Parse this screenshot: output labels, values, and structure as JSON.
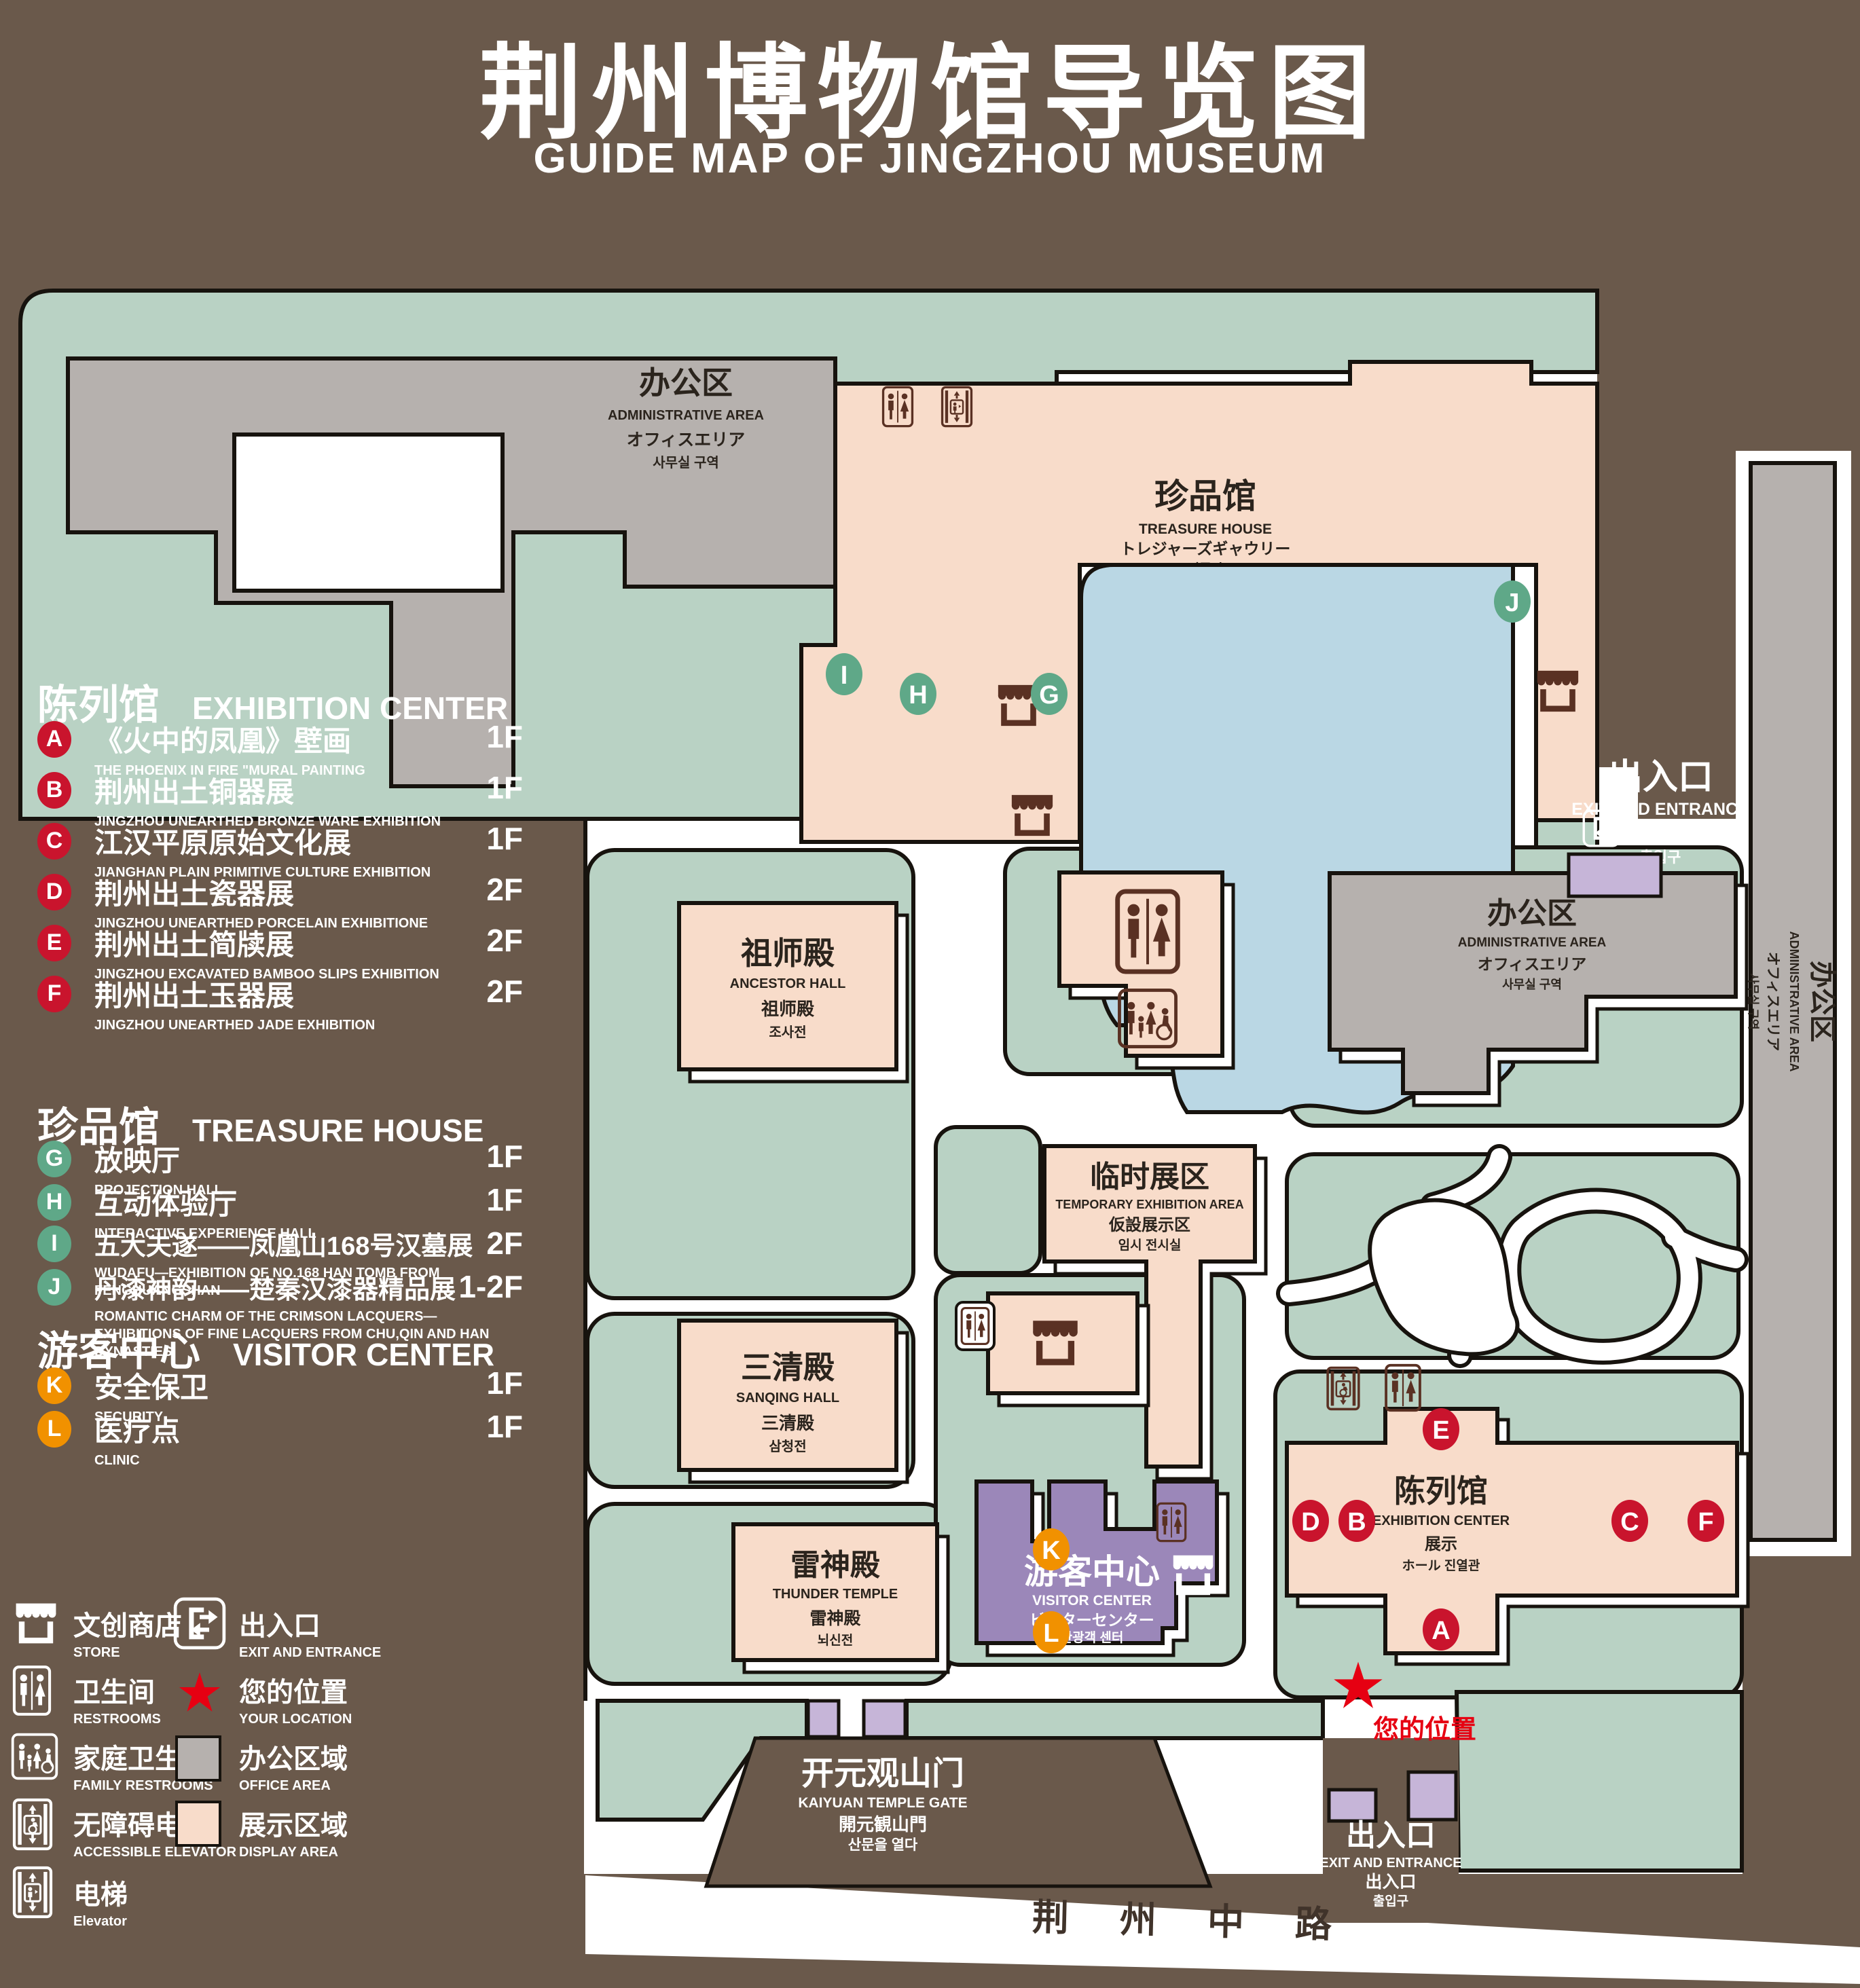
{
  "title": {
    "zh": "荆州博物馆导览图",
    "en": "GUIDE MAP OF JINGZHOU MUSEUM"
  },
  "colors": {
    "background_brown": "#6a594b",
    "landscape_green": "#b9d2c4",
    "display_pink": "#f8dcca",
    "office_gray": "#b6b1ae",
    "pond_blue": "#bad7e4",
    "visitor_purple": "#9b87b9",
    "gate_purple": "#c6b5d8",
    "marker_red": "#c9142d",
    "marker_green": "#5fa888",
    "marker_orange": "#f19100",
    "location_red": "#e60012",
    "icon_brown": "#5a3123",
    "outline": "#17130e"
  },
  "legend": {
    "sections": [
      {
        "heading_zh": "陈列馆",
        "heading_en": "EXHIBITION CENTER",
        "items": [
          {
            "letter": "A",
            "zh": "《火中的凤凰》壁画",
            "en": "THE PHOENIX IN FIRE \"MURAL PAINTING",
            "floor": "1F"
          },
          {
            "letter": "B",
            "zh": "荆州出土铜器展",
            "en": "JINGZHOU UNEARTHED BRONZE WARE EXHIBITION",
            "floor": "1F"
          },
          {
            "letter": "C",
            "zh": "江汉平原原始文化展",
            "en": "JIANGHAN PLAIN PRIMITIVE CULTURE EXHIBITION",
            "floor": "1F"
          },
          {
            "letter": "D",
            "zh": "荆州出土瓷器展",
            "en": "JINGZHOU UNEARTHED PORCELAIN EXHIBITIONE",
            "floor": "2F"
          },
          {
            "letter": "E",
            "zh": "荆州出土简牍展",
            "en": "JINGZHOU EXCAVATED BAMBOO SLIPS EXHIBITION",
            "floor": "2F"
          },
          {
            "letter": "F",
            "zh": "荆州出土玉器展",
            "en": "JINGZHOU UNEARTHED JADE EXHIBITION",
            "floor": "2F"
          }
        ]
      },
      {
        "heading_zh": "珍品馆",
        "heading_en": "TREASURE HOUSE",
        "items": [
          {
            "letter": "G",
            "zh": "放映厅",
            "en": "PROJECTION HALL",
            "floor": "1F"
          },
          {
            "letter": "H",
            "zh": "互动体验厅",
            "en": "INTERACTIVE EXPERIENCE HALL",
            "floor": "1F"
          },
          {
            "letter": "I",
            "zh": "五大夫遂——凤凰山168号汉墓展",
            "en": "WUDAFU—EXHIBITION OF NO.168 HAN TOMB FROM FENGHUANGSHAN",
            "floor": "2F"
          },
          {
            "letter": "J",
            "zh": "丹漆神韵——楚秦汉漆器精品展",
            "en": "ROMANTIC CHARM OF THE CRIMSON LACQUERS—EXHIBITIONS OF FINE LACQUERS FROM CHU,QIN AND HAN DYNASTIES",
            "floor": "1-2F"
          }
        ]
      },
      {
        "heading_zh": "游客中心",
        "heading_en": "VISITOR CENTER",
        "items": [
          {
            "letter": "K",
            "zh": "安全保卫",
            "en": "SECURITY",
            "floor": "1F"
          },
          {
            "letter": "L",
            "zh": "医疗点",
            "en": "CLINIC",
            "floor": "1F"
          }
        ]
      }
    ],
    "symbols": {
      "store": {
        "zh": "文创商店",
        "en": "STORE"
      },
      "restrooms": {
        "zh": "卫生间",
        "en": "RESTROOMS"
      },
      "family_restrooms": {
        "zh": "家庭卫生间",
        "en": "FAMILY RESTROOMS"
      },
      "accessible_elevator": {
        "zh": "无障碍电梯",
        "en": "ACCESSIBLE  ELEVATOR"
      },
      "elevator": {
        "zh": "电梯",
        "en": "Elevator"
      },
      "exit": {
        "zh": "出入口",
        "en": "EXIT AND ENTRANCE"
      },
      "your_location": {
        "zh": "您的位置",
        "en": "YOUR LOCATION"
      },
      "office_area": {
        "zh": "办公区域",
        "en": "OFFICE AREA"
      },
      "display_area": {
        "zh": "展示区域",
        "en": "DISPLAY AREA"
      }
    }
  },
  "map": {
    "nw_admin": {
      "l1": "办公区",
      "l2": "ADMINISTRATIVE AREA",
      "l3": "オフィスエリア",
      "l4": "사무실 구역"
    },
    "mid_admin": {
      "l1": "办公区",
      "l2": "ADMINISTRATIVE AREA",
      "l3": "オフィスエリア",
      "l4": "사무실 구역"
    },
    "east_admin": {
      "l1": "办公区",
      "l2": "ADMINISTRATIVE AREA",
      "l3": "オフィスエリア",
      "l4": "사무실 구역"
    },
    "treasure_house": {
      "l1": "珍品馆",
      "l2": "TREASURE HOUSE",
      "l3": "トレジャーズギャウリー",
      "l4": "진품관"
    },
    "ancestor_hall": {
      "l1": "祖师殿",
      "l2": "ANCESTOR HALL",
      "l3": "祖师殿",
      "l4": "조사전"
    },
    "sanqing_hall": {
      "l1": "三清殿",
      "l2": "SANQING HALL",
      "l3": "三清殿",
      "l4": "삼청전"
    },
    "thunder_temple": {
      "l1": "雷神殿",
      "l2": "THUNDER TEMPLE",
      "l3": "雷神殿",
      "l4": "뇌신전"
    },
    "temporary_exhibition": {
      "l1": "临时展区",
      "l2": "TEMPORARY EXHIBITION AREA",
      "l3": "仮設展示区",
      "l4": "임시 전시실"
    },
    "visitor_center": {
      "l1": "游客中心",
      "l2": "VISITOR CENTER",
      "l3": "ビジターセンター",
      "l4": "관광객 센터"
    },
    "exhibition_center": {
      "l1": "陈列馆",
      "l2": "EXHIBITION CENTER",
      "l3": "展示",
      "l4": "ホール 진열관"
    },
    "gate": {
      "l1": "开元观山门",
      "l2": "KAIYUAN TEMPLE GATE",
      "l3": "開元観山門",
      "l4": "산문을 열다"
    },
    "exit_ne": {
      "l1": "出入口",
      "l2": "EXIT AND ENTRANCE",
      "l3": "出入口",
      "l4": "출입구"
    },
    "exit_s": {
      "l1": "出入口",
      "l2": "EXIT AND ENTRANCE",
      "l3": "出入口",
      "l4": "출입구"
    },
    "road": "荆 州 中 路",
    "your_location": "您的位置",
    "markers": {
      "A": "A",
      "B": "B",
      "C": "C",
      "D": "D",
      "E": "E",
      "F": "F",
      "G": "G",
      "H": "H",
      "I": "I",
      "J": "J",
      "K": "K",
      "L": "L"
    }
  }
}
